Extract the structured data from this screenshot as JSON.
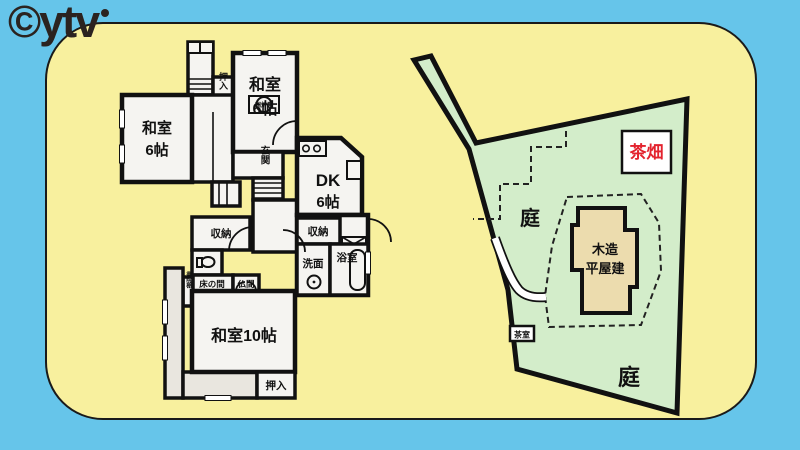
{
  "logo": {
    "text": "©ytv"
  },
  "floor": {
    "washitsu_top": {
      "l1": "和室",
      "l2": "6帖"
    },
    "washitsu_left": {
      "l1": "和室",
      "l2": "6帖"
    },
    "dk": {
      "l1": "DK",
      "l2": "6帖"
    },
    "washitsu_10": "和室10帖",
    "oshiire_top": "押入",
    "oshiire_bottom": "押入",
    "genkan": "玄関",
    "irori": "囲炉裏",
    "shuno_left": "収納",
    "shuno_right": "収納",
    "senmen": "洗面",
    "yokushitsu": "浴室",
    "tokonoma": "床の間",
    "butsuma": "仏間",
    "shoin": "書院棚"
  },
  "site": {
    "tea_field": "茶畑",
    "garden_upper": "庭",
    "garden_lower": "庭",
    "building_l1": "木造",
    "building_l2": "平屋建",
    "tea_room": "茶室"
  },
  "colors": {
    "background": "#66c5ea",
    "card": "#f8f09e",
    "site_green": "#d3edca",
    "building_tan": "#ecdcae",
    "accent_red": "#e3232e",
    "line": "#111111"
  }
}
